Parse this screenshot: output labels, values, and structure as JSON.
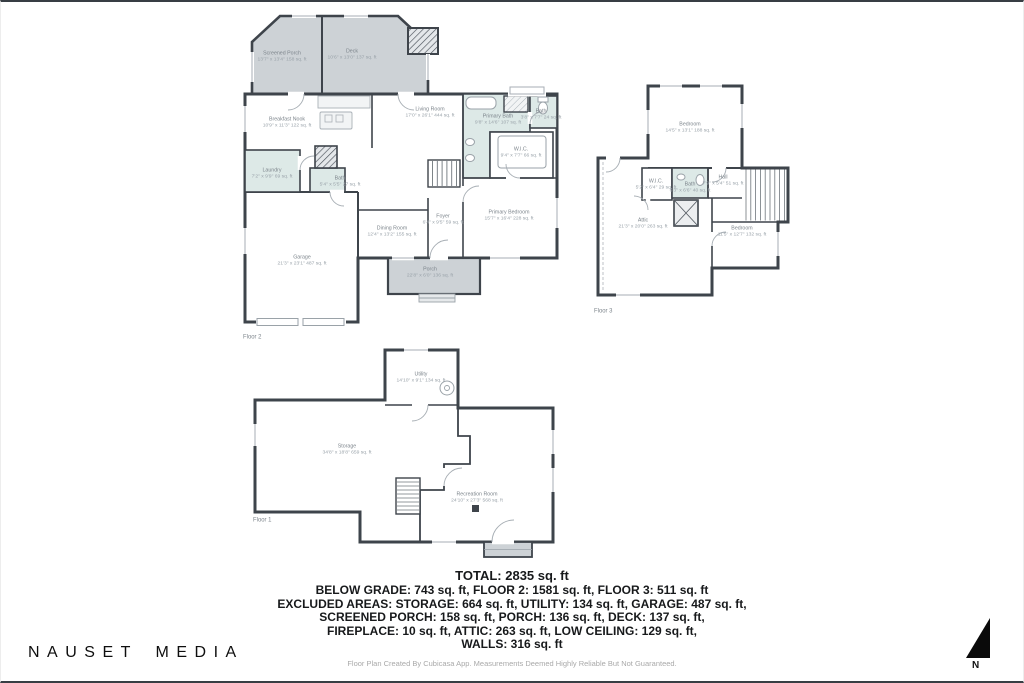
{
  "meta": {
    "brand": "NAUSET MEDIA",
    "compass_label": "N",
    "footer": "Floor Plan Created By Cubicasa App. Measurements Deemed Highly Reliable But Not Guaranteed."
  },
  "palette": {
    "wall": "#3e444b",
    "area_gray": "#cdd2d6",
    "bath_teal": "#dde9e7",
    "label_gray": "#7c848b"
  },
  "summary": {
    "total": "TOTAL: 2835 sq. ft",
    "lines": [
      "BELOW GRADE: 743 sq. ft, FLOOR 2: 1581 sq. ft, FLOOR 3: 511 sq. ft",
      "EXCLUDED AREAS: STORAGE: 664 sq. ft, UTILITY: 134 sq. ft, GARAGE: 487 sq. ft,",
      "SCREENED PORCH: 158 sq. ft, PORCH: 136 sq. ft, DECK: 137 sq. ft,",
      "FIREPLACE: 10 sq. ft, ATTIC: 263 sq. ft, LOW CEILING: 129 sq. ft,",
      "WALLS: 316 sq. ft"
    ]
  },
  "floors": [
    {
      "label": "Floor 2",
      "rooms": [
        {
          "name": "Screened Porch",
          "dims": "13'7\" x 13'4\" 158 sq. ft"
        },
        {
          "name": "Deck",
          "dims": "10'6\" x 13'0\" 137 sq. ft"
        },
        {
          "name": "Living Room",
          "dims": "17'0\" x 26'1\" 444 sq. ft"
        },
        {
          "name": "Breakfast Nook",
          "dims": "10'9\" x 11'3\" 122 sq. ft"
        },
        {
          "name": "Laundry",
          "dims": "7'2\" x 9'9\" 69 sq. ft"
        },
        {
          "name": "Bath",
          "dims": "5'4\" x 5'5\" 27 sq. ft"
        },
        {
          "name": "Garage",
          "dims": "21'3\" x 23'1\" 487 sq. ft"
        },
        {
          "name": "Dining Room",
          "dims": "12'4\" x 13'2\" 155 sq. ft"
        },
        {
          "name": "Foyer",
          "dims": "6'4\" x 9'5\" 59 sq. ft"
        },
        {
          "name": "Porch",
          "dims": "22'8\" x 6'0\" 136 sq. ft"
        },
        {
          "name": "Primary Bath",
          "dims": "9'8\" x 14'6\" 107 sq. ft"
        },
        {
          "name": "Bath",
          "dims": "3'8\" x 7'7\" 24 sq. ft"
        },
        {
          "name": "W.I.C.",
          "dims": "9'4\" x 7'7\" 66 sq. ft"
        },
        {
          "name": "Primary Bedroom",
          "dims": "15'7\" x 16'4\" 228 sq. ft"
        }
      ]
    },
    {
      "label": "Floor 3",
      "rooms": [
        {
          "name": "Bedroom",
          "dims": "14'5\" x 13'1\" 188 sq. ft"
        },
        {
          "name": "W.I.C.",
          "dims": "5'2\" x 6'4\" 29 sq. ft"
        },
        {
          "name": "Bath",
          "dims": "6'3\" x 6'6\" 40 sq. ft"
        },
        {
          "name": "Hall",
          "dims": "7'9\" x 5'4\" 51 sq. ft"
        },
        {
          "name": "Attic",
          "dims": "21'3\" x 20'0\" 263 sq. ft"
        },
        {
          "name": "Bedroom",
          "dims": "11'5\" x 12'7\" 132 sq. ft"
        }
      ]
    },
    {
      "label": "Floor 1",
      "rooms": [
        {
          "name": "Utility",
          "dims": "14'10\" x 9'1\" 134 sq. ft"
        },
        {
          "name": "Storage",
          "dims": "34'8\" x 18'8\" 659 sq. ft"
        },
        {
          "name": "Recreation Room",
          "dims": "24'10\" x 27'3\" 568 sq. ft"
        }
      ]
    }
  ]
}
